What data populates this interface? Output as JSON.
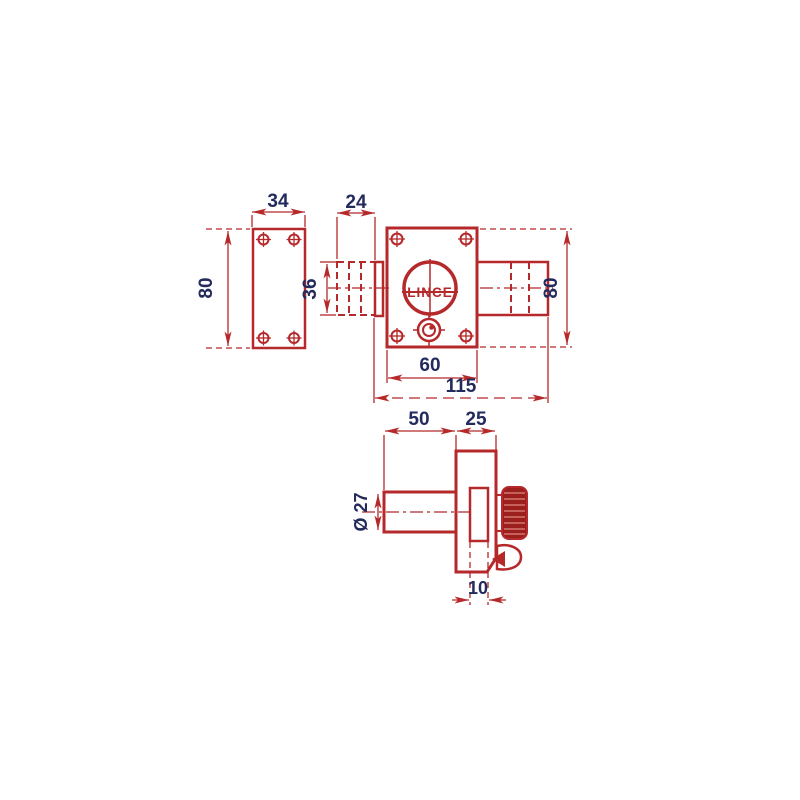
{
  "diagram": {
    "brand_label": "LINCE",
    "colors": {
      "line_red": "#b5292b",
      "knob_fill": "#9c1f1d",
      "dimension_text": "#232a5c"
    },
    "front_view": {
      "plate_width": "34",
      "plate_height": "80",
      "bolt_protrusion": "24",
      "bolt_height": "36",
      "body_width": "60",
      "overall_width": "115",
      "body_height": "80"
    },
    "side_view": {
      "barrel_length": "50",
      "body_depth": "25",
      "barrel_diameter": "Ø 27",
      "bolt_thickness": "10"
    }
  }
}
